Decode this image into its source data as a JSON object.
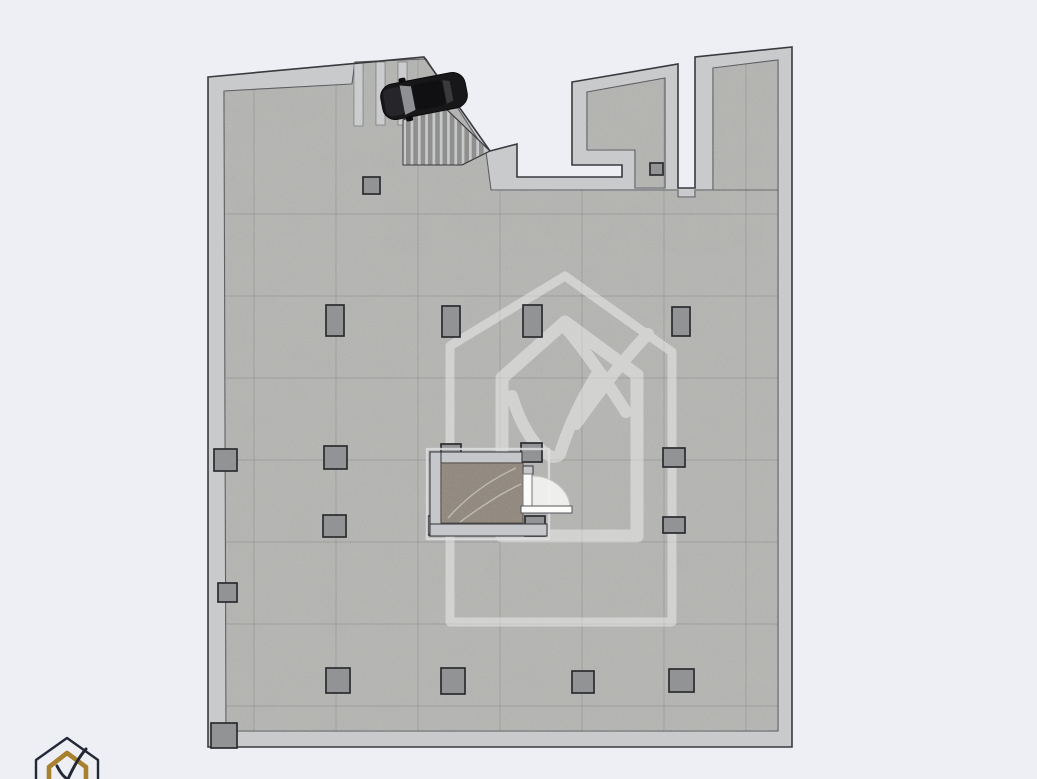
{
  "scene": {
    "kind": "basement-parking-floor-plan",
    "width": 1037,
    "height": 779,
    "background": "#edeff4"
  },
  "palette": {
    "background": "#edeff4",
    "wall_fill": "#c9cacc",
    "wall_outline": "#3a3a3e",
    "floor_base": "#b0b0ae",
    "floor_edge_line": "#55555a",
    "column_fill": "#919395",
    "column_outline": "#2c2c30",
    "stair_base": "#c7c8ca",
    "stair_tread": "#8f8f8d",
    "bay_stripe": "#cbccce",
    "elevator_cab_marble": "#8d8479",
    "elevator_core_wall": "#c6c7ca",
    "door_swing_white": "#f3f3f1",
    "car_body": "#17171a",
    "watermark_opacity": 0.4,
    "logo_gold": "#a8812f",
    "logo_dark": "#232836"
  },
  "grid": {
    "vertical_x": [
      254,
      336,
      418,
      500,
      582,
      664,
      746
    ],
    "horizontal_y": [
      214,
      296,
      378,
      460,
      542,
      624,
      706
    ]
  },
  "columns": {
    "count": 21,
    "items": [
      {
        "x": 363,
        "y": 177,
        "w": 17,
        "h": 17
      },
      {
        "x": 650,
        "y": 163,
        "w": 13,
        "h": 12
      },
      {
        "x": 326,
        "y": 305,
        "w": 18,
        "h": 31
      },
      {
        "x": 442,
        "y": 306,
        "w": 18,
        "h": 31
      },
      {
        "x": 523,
        "y": 305,
        "w": 19,
        "h": 32
      },
      {
        "x": 672,
        "y": 307,
        "w": 18,
        "h": 29
      },
      {
        "x": 214,
        "y": 449,
        "w": 23,
        "h": 22
      },
      {
        "x": 324,
        "y": 446,
        "w": 23,
        "h": 23
      },
      {
        "x": 441,
        "y": 444,
        "w": 20,
        "h": 19
      },
      {
        "x": 521,
        "y": 443,
        "w": 21,
        "h": 19
      },
      {
        "x": 663,
        "y": 448,
        "w": 22,
        "h": 19
      },
      {
        "x": 428,
        "y": 516,
        "w": 19,
        "h": 19
      },
      {
        "x": 525,
        "y": 516,
        "w": 20,
        "h": 20
      },
      {
        "x": 323,
        "y": 515,
        "w": 23,
        "h": 22
      },
      {
        "x": 663,
        "y": 517,
        "w": 22,
        "h": 16
      },
      {
        "x": 218,
        "y": 583,
        "w": 19,
        "h": 19
      },
      {
        "x": 326,
        "y": 668,
        "w": 24,
        "h": 25
      },
      {
        "x": 441,
        "y": 668,
        "w": 24,
        "h": 26
      },
      {
        "x": 572,
        "y": 671,
        "w": 22,
        "h": 22
      },
      {
        "x": 669,
        "y": 669,
        "w": 25,
        "h": 23
      },
      {
        "x": 211,
        "y": 723,
        "w": 26,
        "h": 25
      }
    ]
  },
  "elements": {
    "car": {
      "x": 424,
      "y": 96,
      "angle": -11,
      "length": 86,
      "width": 36
    },
    "staircase": {
      "treads": 11,
      "tread_step": 7.3,
      "tread_width": 4.6
    },
    "parking_bay": {
      "stripes": 3
    },
    "elevator_core": {
      "has_door_swing": true,
      "door_side": "right"
    },
    "watermark": {
      "motif": "house-with-checkmark"
    },
    "brand_logo": {
      "motif": "house-with-checkmark",
      "position": "bottom-left"
    }
  }
}
